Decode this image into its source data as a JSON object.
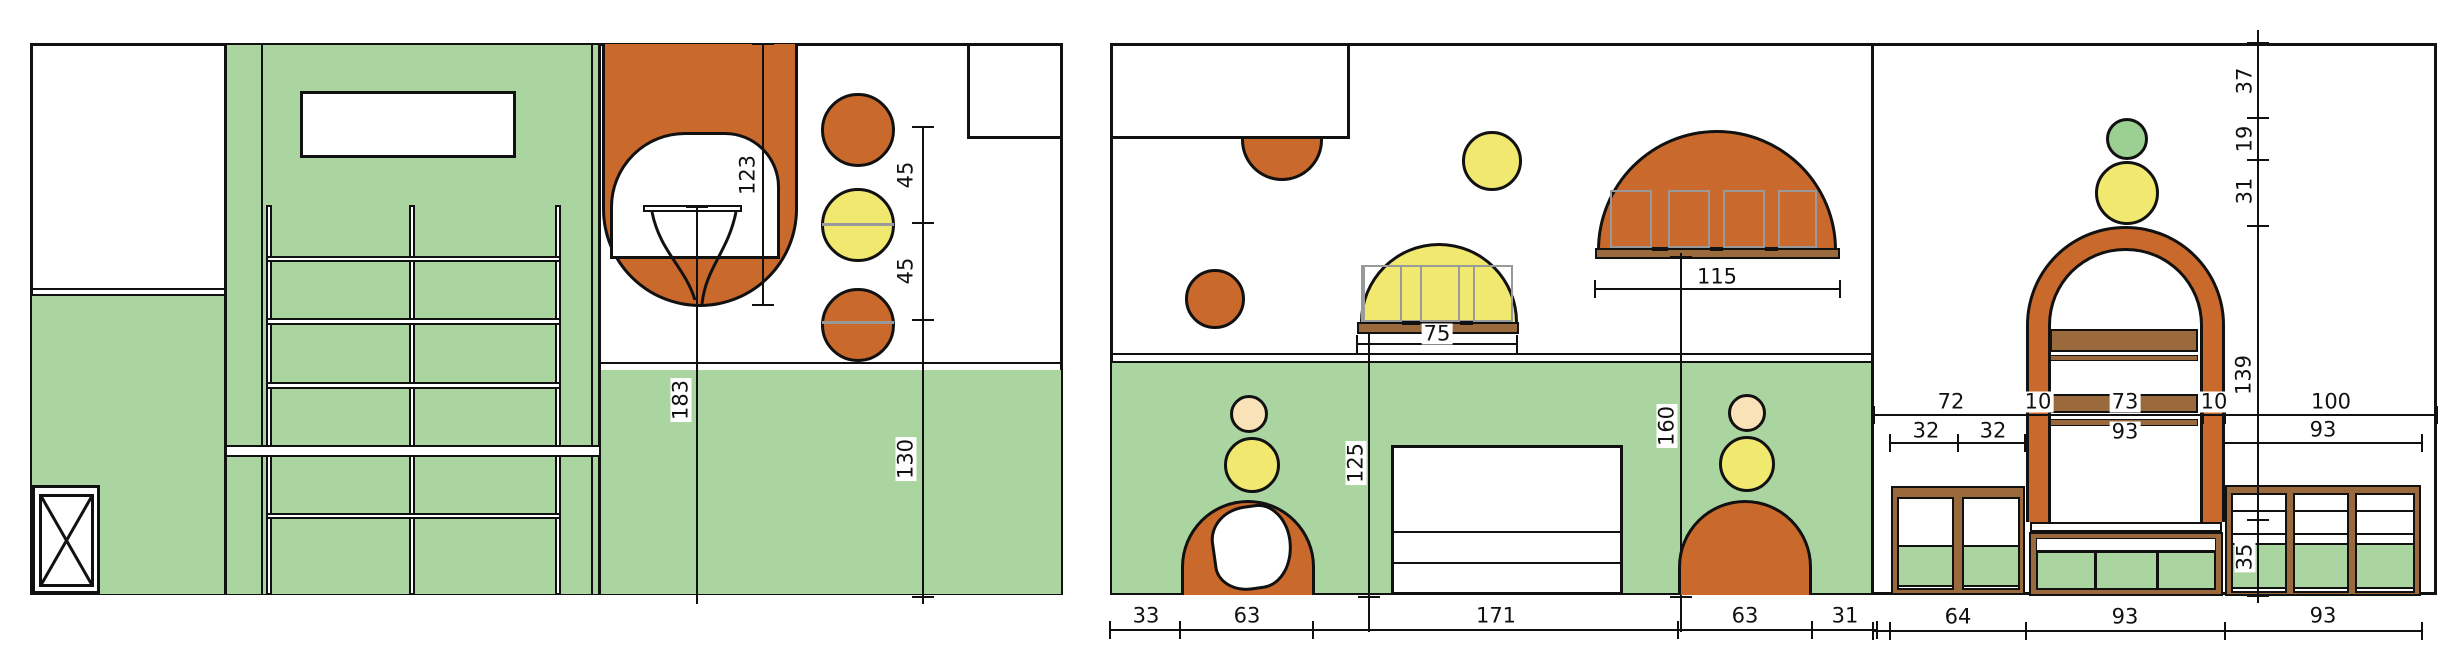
{
  "drawing_type": "interior elevation drawings",
  "colors": {
    "wall_green": "#ABD5A0",
    "accent_orange": "#C9692B",
    "accent_yellow": "#F1E870",
    "accent_skin": "#FAE2B8",
    "wood_brown": "#9A6A3C",
    "pane_gray": "#999999",
    "line_black": "#111111"
  },
  "dims": {
    "left": {
      "opening": "123",
      "table": "183",
      "gap1": "45",
      "gap2": "45",
      "wainscot": "130"
    },
    "right": {
      "awning": "75",
      "canopy": "115",
      "sideboard": "125",
      "canopy_h": "160",
      "col": [
        "37",
        "19",
        "31",
        "139",
        "35"
      ],
      "row1": [
        "72",
        "10",
        "73",
        "10",
        "100"
      ],
      "row2": [
        "32",
        "32",
        "93",
        "93"
      ],
      "bottom": [
        "33",
        "63",
        "171",
        "63",
        "31",
        "64",
        "93",
        "93"
      ]
    }
  }
}
